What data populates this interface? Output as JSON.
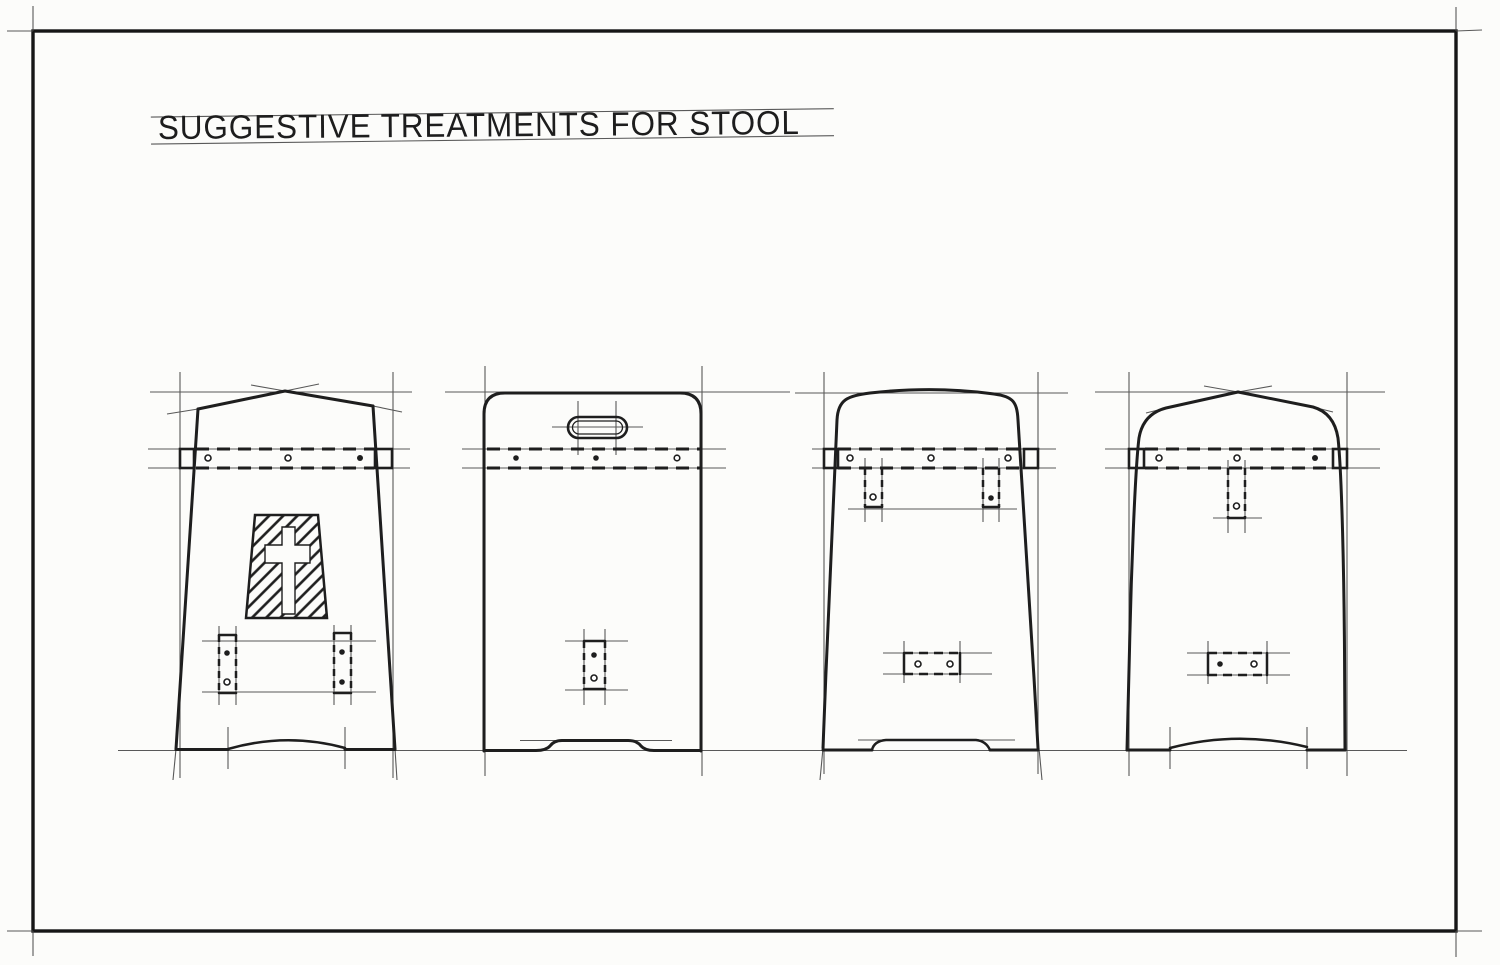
{
  "sheet": {
    "title": "SUGGESTIVE TREATMENTS FOR STOOL"
  },
  "palette": {
    "paper": "#fcfcfa",
    "ink": "#1e1e1e",
    "construction_line": "#474747"
  },
  "drawings": [
    {
      "label": "stool-end-peaked-top-with-cross-cutout",
      "details": "peaked gable top, dashed seat rail with three pins, hatched trapezoid panel with cross cut-out, two side stretcher mortises, arched foot cut-out"
    },
    {
      "label": "stool-end-round-corner-top-with-handle-slot",
      "details": "flat top with rounded corners, oval hand-slot, dashed seat rail with three pins, single center stretcher mortise, flat notched foot cut-out"
    },
    {
      "label": "stool-end-crowned-top-with-twin-battens",
      "details": "gently crowned top, tapered sides, dashed seat rail with three pins, two hanging battens, center stretcher mortise, flat notched foot cut-out"
    },
    {
      "label": "stool-end-domed-top-with-center-batten",
      "details": "peaked domed top with curved shoulders, dashed seat rail with three pins, single center batten, center stretcher mortise, arched foot cut-out"
    }
  ]
}
